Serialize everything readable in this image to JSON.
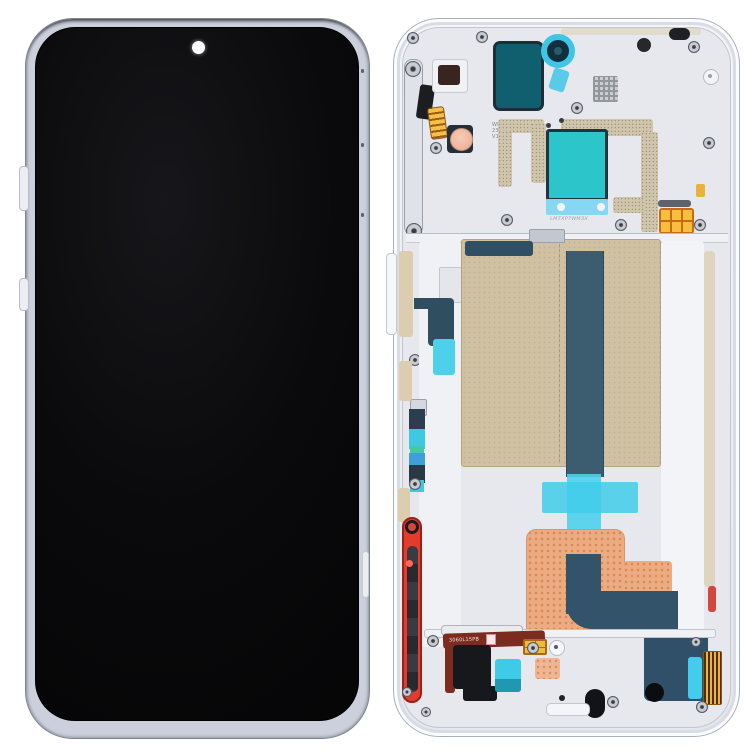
{
  "scene": {
    "kind": "product-photo",
    "subject": "Phone LCD screen and digitizer full assembly with frame (front display + rear mid-frame)",
    "background_color": "#ffffff"
  },
  "front_assembly": {
    "screen_color": "#08080a",
    "frame_color": "#ccd0dc",
    "punch_hole_color": "#fdfdfd"
  },
  "rear_assembly": {
    "labels": {
      "flex_marking": "3060L15PB",
      "plate_marking_lines": [
        "WDT",
        "23M1",
        "V1"
      ],
      "molded_marking": "LM7XP7WM3X"
    },
    "colors": {
      "rear_frame": "#eef0f4",
      "rear_plate": "#e6e8ed",
      "graphite_sheet_tan": "#cfc1a2",
      "flex_navy": "#33536a",
      "adhesive_cyan": "#3ecbe8",
      "adhesive_teal_patch": "#2cc5c9",
      "camera_seal_teal": "#0f5f6e",
      "copper_flex": "#ecab80",
      "power_button_red": "#e23c2e",
      "connector_gold": "#f4b83c",
      "antenna_trace_gold": "#cfc5ab"
    }
  }
}
